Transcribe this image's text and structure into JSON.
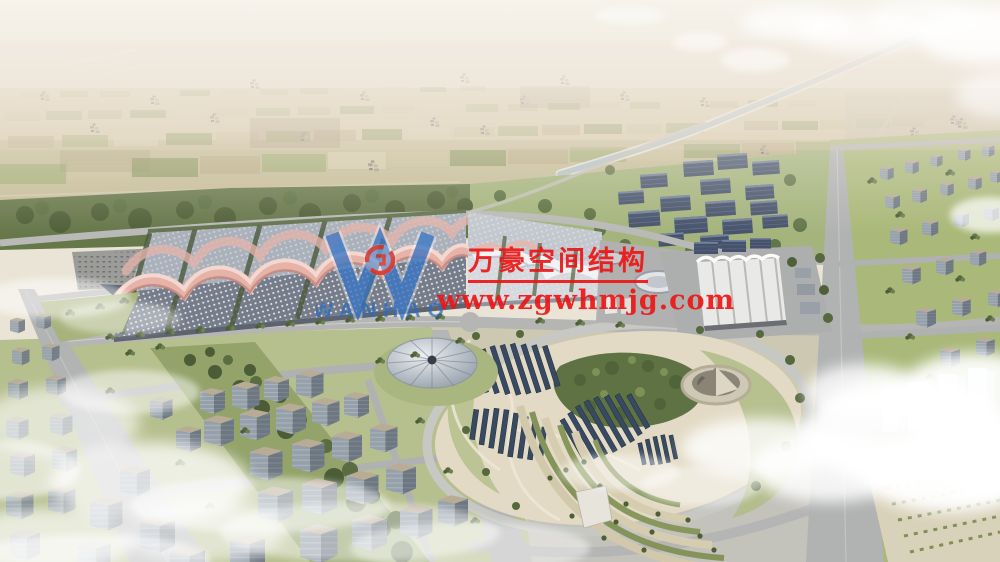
{
  "watermark": {
    "company_name": "万豪空间结构",
    "website": "www.zgwhmjg.com",
    "logo_text": "WANHAO"
  },
  "colors": {
    "wm_red": "#ed1515",
    "logo_blue": "#2a6cc0",
    "emblem_red": "#d5342c",
    "roof_pink": "#e5b3a8",
    "solar_panel": "#384a62",
    "road_grey": "#b4b5b4",
    "field_tan": "#cbc19c",
    "field_green": "#8e9a62"
  }
}
